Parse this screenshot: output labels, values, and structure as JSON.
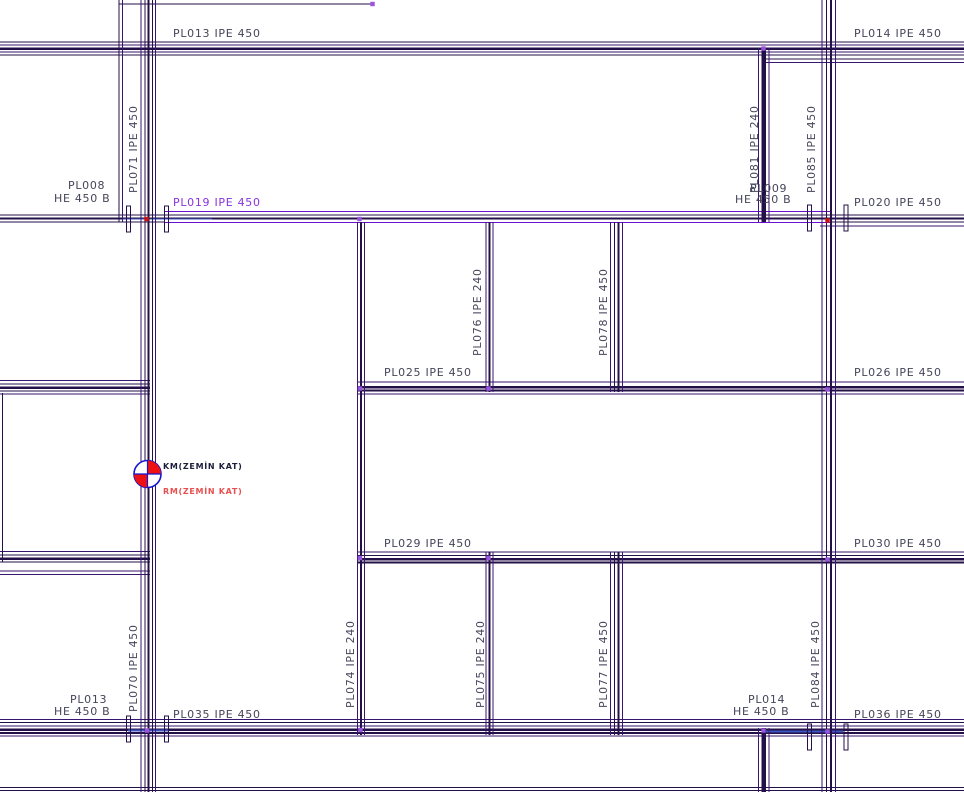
{
  "drawing_title": "steel-beam-framing-plan-ground-floor",
  "colors": {
    "dark": "#241048",
    "mid": "#38156e",
    "purple": "#6a10d0",
    "purple_text": "#8833dd",
    "node_purple": "#9955dd",
    "node_red": "#cc1111",
    "blue": "#3d55c0",
    "text": "#45455a",
    "km_text": "#1d1d3c",
    "rm_text": "#e85050",
    "marker_blue": "#1515cc",
    "marker_red": "#ee1111"
  },
  "labels": [
    {
      "id": "pl013-ipe-450-top",
      "text": "PL013 IPE 450",
      "x": 173,
      "y": 37,
      "rotate": 0
    },
    {
      "id": "pl014-ipe-450-top",
      "text": "PL014 IPE 450",
      "x": 854,
      "y": 37,
      "rotate": 0
    },
    {
      "id": "pl008-name",
      "text": "PL008",
      "x": 68,
      "y": 189,
      "rotate": 0
    },
    {
      "id": "pl008-section",
      "text": "HE 450 B",
      "x": 54,
      "y": 202,
      "rotate": 0
    },
    {
      "id": "pl071-ipe-450",
      "text": "PL071 IPE 450",
      "x": 137,
      "y": 193,
      "rotate": -90
    },
    {
      "id": "pl019-ipe-450",
      "text": "PL019 IPE 450",
      "x": 173,
      "y": 206,
      "rotate": 0,
      "color": "purple_text"
    },
    {
      "id": "pl081-ipe-240",
      "text": "PL081 IPE 240",
      "x": 758,
      "y": 193,
      "rotate": -90
    },
    {
      "id": "pl009-name",
      "text": "PL009",
      "x": 750,
      "y": 192,
      "rotate": 0
    },
    {
      "id": "pl009-section",
      "text": "HE 450 B",
      "x": 735,
      "y": 203,
      "rotate": 0
    },
    {
      "id": "pl085-ipe-450",
      "text": "PL085 IPE 450",
      "x": 815,
      "y": 193,
      "rotate": -90
    },
    {
      "id": "pl020-ipe-450",
      "text": "PL020 IPE 450",
      "x": 854,
      "y": 206,
      "rotate": 0
    },
    {
      "id": "pl076-ipe-240",
      "text": "PL076 IPE 240",
      "x": 481,
      "y": 356,
      "rotate": -90
    },
    {
      "id": "pl078-ipe-450",
      "text": "PL078 IPE 450",
      "x": 607,
      "y": 356,
      "rotate": -90
    },
    {
      "id": "pl025-ipe-450",
      "text": "PL025 IPE 450",
      "x": 384,
      "y": 376,
      "rotate": 0
    },
    {
      "id": "pl026-ipe-450",
      "text": "PL026 IPE 450",
      "x": 854,
      "y": 376,
      "rotate": 0
    },
    {
      "id": "km-level-label",
      "text": "KM(ZEMİN KAT)",
      "x": 163,
      "y": 469,
      "rotate": 0,
      "color": "km_text",
      "size": 8,
      "bold": true
    },
    {
      "id": "rm-level-label",
      "text": "RM(ZEMİN KAT)",
      "x": 163,
      "y": 494,
      "rotate": 0,
      "color": "rm_text",
      "size": 8,
      "bold": true
    },
    {
      "id": "pl029-ipe-450",
      "text": "PL029 IPE 450",
      "x": 384,
      "y": 547,
      "rotate": 0
    },
    {
      "id": "pl030-ipe-450",
      "text": "PL030 IPE 450",
      "x": 854,
      "y": 547,
      "rotate": 0
    },
    {
      "id": "pl074-ipe-240",
      "text": "PL074 IPE 240",
      "x": 354,
      "y": 708,
      "rotate": -90
    },
    {
      "id": "pl075-ipe-240",
      "text": "PL075 IPE 240",
      "x": 484,
      "y": 708,
      "rotate": -90
    },
    {
      "id": "pl077-ipe-450",
      "text": "PL077 IPE 450",
      "x": 607,
      "y": 708,
      "rotate": -90
    },
    {
      "id": "pl070-ipe-450",
      "text": "PL070 IPE 450",
      "x": 137,
      "y": 712,
      "rotate": -90
    },
    {
      "id": "pl084-ipe-450",
      "text": "PL084 IPE 450",
      "x": 819,
      "y": 708,
      "rotate": -90
    },
    {
      "id": "pl013-name-bottom",
      "text": "PL013",
      "x": 70,
      "y": 703,
      "rotate": 0
    },
    {
      "id": "pl013-section-bottom",
      "text": "HE 450 B",
      "x": 54,
      "y": 715,
      "rotate": 0
    },
    {
      "id": "pl035-ipe-450",
      "text": "PL035 IPE 450",
      "x": 173,
      "y": 718,
      "rotate": 0
    },
    {
      "id": "pl014-name-bottom",
      "text": "PL014",
      "x": 748,
      "y": 703,
      "rotate": 0
    },
    {
      "id": "pl014-section-bottom",
      "text": "HE 450 B",
      "x": 733,
      "y": 715,
      "rotate": 0
    },
    {
      "id": "pl036-ipe-450",
      "text": "PL036 IPE 450",
      "x": 854,
      "y": 718,
      "rotate": 0
    }
  ],
  "beams": {
    "horizontal": [
      [
        4,
        119,
        373,
        1,
        "dark"
      ],
      [
        42,
        0,
        964,
        1,
        "dark"
      ],
      [
        45,
        0,
        964,
        1,
        "mid"
      ],
      [
        48.5,
        0,
        964,
        2.5,
        "dark"
      ],
      [
        52,
        0,
        964,
        1,
        "mid"
      ],
      [
        55,
        0,
        964,
        1,
        "dark"
      ],
      [
        59,
        765,
        964,
        1,
        "dark"
      ],
      [
        62.5,
        765,
        964,
        1,
        "mid"
      ],
      [
        211.5,
        165,
        830,
        1.3,
        "purple"
      ],
      [
        222.5,
        165,
        830,
        1.3,
        "purple"
      ],
      [
        215,
        0,
        964,
        1,
        "dark"
      ],
      [
        218.5,
        0,
        964,
        1.6,
        "dark"
      ],
      [
        222.2,
        0,
        165,
        1,
        "dark"
      ],
      [
        222.2,
        830,
        964,
        1,
        "dark"
      ],
      [
        226,
        820,
        964,
        1,
        "mid"
      ],
      [
        380.5,
        0,
        150,
        1,
        "mid"
      ],
      [
        384,
        0,
        150,
        1,
        "dark"
      ],
      [
        387.5,
        0,
        150,
        2.5,
        "dark"
      ],
      [
        391,
        0,
        150,
        1,
        "dark"
      ],
      [
        394,
        0,
        150,
        1,
        "mid"
      ],
      [
        382,
        357,
        964,
        1,
        "mid"
      ],
      [
        387,
        357,
        964,
        2.5,
        "dark"
      ],
      [
        390.5,
        357,
        964,
        1.6,
        "dark"
      ],
      [
        394,
        357,
        964,
        1,
        "mid"
      ],
      [
        551.5,
        0,
        150,
        1,
        "mid"
      ],
      [
        555,
        0,
        150,
        1,
        "dark"
      ],
      [
        558.5,
        0,
        150,
        2.5,
        "dark"
      ],
      [
        562,
        0,
        150,
        1,
        "dark"
      ],
      [
        571,
        0,
        150,
        1,
        "mid"
      ],
      [
        574.5,
        0,
        150,
        1,
        "mid"
      ],
      [
        552,
        357,
        964,
        1,
        "mid"
      ],
      [
        555.5,
        357,
        964,
        1,
        "dark"
      ],
      [
        559,
        357,
        964,
        2.5,
        "dark"
      ],
      [
        562.5,
        357,
        964,
        1.6,
        "dark"
      ],
      [
        719.5,
        0,
        964,
        1,
        "mid"
      ],
      [
        722.5,
        0,
        964,
        1,
        "dark"
      ],
      [
        726,
        0,
        964,
        1,
        "mid"
      ],
      [
        729.5,
        0,
        964,
        2.5,
        "dark"
      ],
      [
        733,
        0,
        964,
        1.6,
        "dark"
      ],
      [
        736,
        0,
        964,
        1,
        "mid"
      ],
      [
        730.5,
        128,
        168,
        2,
        "blue"
      ],
      [
        731.5,
        763,
        843,
        1.6,
        "blue"
      ],
      [
        219,
        122,
        212,
        1.4,
        "blue"
      ],
      [
        787.5,
        0,
        964,
        1.2,
        "dark"
      ],
      [
        790.5,
        0,
        964,
        1.2,
        "dark"
      ]
    ],
    "vertical": [
      [
        119,
        0,
        222,
        1,
        "dark"
      ],
      [
        122.5,
        0,
        222,
        1,
        "mid"
      ],
      [
        141,
        0,
        792,
        1,
        "mid"
      ],
      [
        145,
        0,
        792,
        1.2,
        "dark"
      ],
      [
        148.5,
        0,
        792,
        2.2,
        "dark"
      ],
      [
        152.5,
        0,
        792,
        1,
        "dark"
      ],
      [
        155.5,
        0,
        792,
        1,
        "mid"
      ],
      [
        357.5,
        222,
        735,
        1,
        "mid"
      ],
      [
        361,
        222,
        735,
        1.8,
        "dark"
      ],
      [
        364.5,
        222,
        735,
        1,
        "mid"
      ],
      [
        486,
        222,
        392,
        1,
        "mid"
      ],
      [
        489.5,
        222,
        392,
        1.6,
        "dark"
      ],
      [
        493,
        222,
        392,
        1,
        "mid"
      ],
      [
        486,
        552,
        735,
        1,
        "mid"
      ],
      [
        489.5,
        552,
        735,
        1.6,
        "dark"
      ],
      [
        493,
        552,
        735,
        1,
        "mid"
      ],
      [
        610.5,
        222,
        392,
        1,
        "mid"
      ],
      [
        614.5,
        222,
        392,
        1,
        "dark"
      ],
      [
        618.5,
        222,
        392,
        1.8,
        "dark"
      ],
      [
        622.5,
        222,
        392,
        1,
        "mid"
      ],
      [
        610.5,
        552,
        735,
        1,
        "mid"
      ],
      [
        614.5,
        552,
        735,
        1,
        "dark"
      ],
      [
        618.5,
        552,
        735,
        1.8,
        "dark"
      ],
      [
        622.5,
        552,
        735,
        1,
        "mid"
      ],
      [
        758.5,
        48,
        222,
        1,
        "mid"
      ],
      [
        763.5,
        48,
        222,
        4.5,
        "dark"
      ],
      [
        769,
        48,
        222,
        1,
        "mid"
      ],
      [
        758.5,
        728,
        792,
        1,
        "mid"
      ],
      [
        763.5,
        728,
        792,
        4.5,
        "dark"
      ],
      [
        769,
        728,
        792,
        1,
        "mid"
      ],
      [
        822,
        0,
        792,
        1,
        "mid"
      ],
      [
        826.5,
        0,
        792,
        1,
        "dark"
      ],
      [
        831,
        0,
        792,
        1.8,
        "dark"
      ],
      [
        835.5,
        0,
        792,
        1,
        "mid"
      ],
      [
        2.5,
        393,
        562,
        1,
        "dark"
      ]
    ]
  },
  "end_ticks": [
    [
      128.5,
      219
    ],
    [
      166.5,
      219
    ],
    [
      809.5,
      218
    ],
    [
      846,
      218
    ],
    [
      128.5,
      729
    ],
    [
      166.5,
      729
    ],
    [
      809.5,
      737
    ],
    [
      846,
      737
    ]
  ],
  "nodes": [
    {
      "x": 372.5,
      "y": 4,
      "c": "node_purple"
    },
    {
      "x": 763.5,
      "y": 48.5,
      "c": "node_purple"
    },
    {
      "x": 146.5,
      "y": 219,
      "c": "node_red"
    },
    {
      "x": 359.5,
      "y": 219,
      "c": "node_purple"
    },
    {
      "x": 827.5,
      "y": 220.5,
      "c": "node_red"
    },
    {
      "x": 360,
      "y": 388.5,
      "c": "node_purple"
    },
    {
      "x": 488.5,
      "y": 388.5,
      "c": "node_purple"
    },
    {
      "x": 827.5,
      "y": 389.5,
      "c": "node_purple"
    },
    {
      "x": 360,
      "y": 558,
      "c": "node_purple"
    },
    {
      "x": 488.5,
      "y": 558,
      "c": "node_purple"
    },
    {
      "x": 827.5,
      "y": 559.5,
      "c": "node_purple"
    },
    {
      "x": 147,
      "y": 730.5,
      "c": "node_purple"
    },
    {
      "x": 360.5,
      "y": 730,
      "c": "node_purple"
    },
    {
      "x": 763.5,
      "y": 730.5,
      "c": "node_purple"
    },
    {
      "x": 827.5,
      "y": 731.5,
      "c": "node_purple"
    }
  ],
  "level_marker": {
    "cx": 147.5,
    "cy": 474,
    "r": 13.5
  }
}
